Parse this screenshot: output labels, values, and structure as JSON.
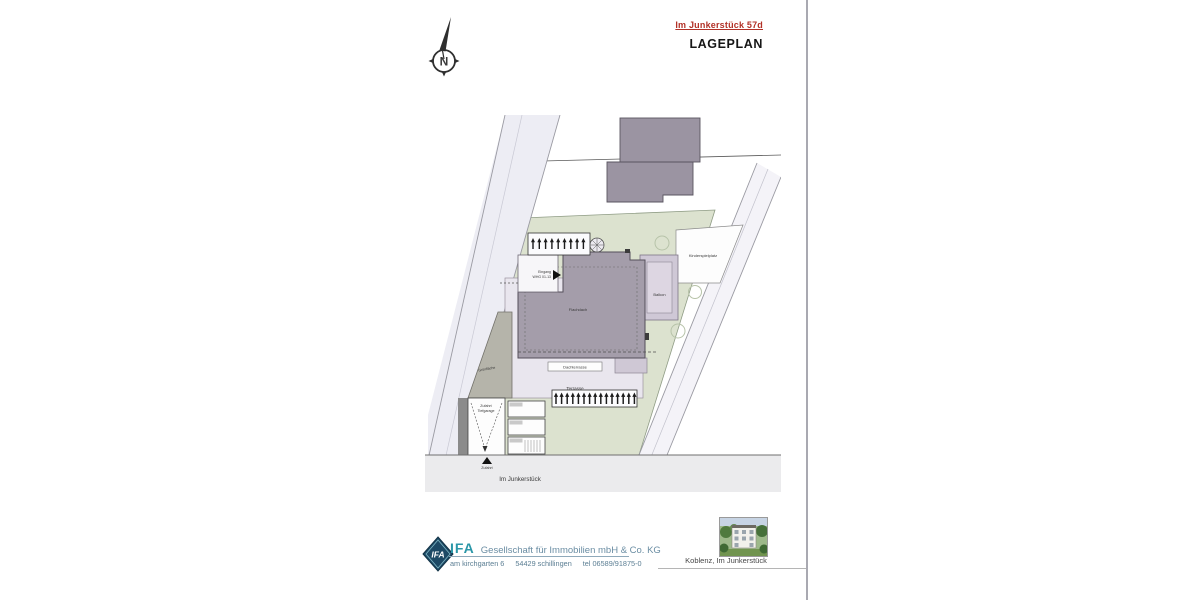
{
  "header": {
    "address": "Im Junkerstück 57d",
    "title": "LAGEPLAN"
  },
  "compass": {
    "letter": "N"
  },
  "plan": {
    "street_label": "Im Junkerstück",
    "areas": {
      "kinderspielplatz": "Kinderspielplatz",
      "balkon": "Balkon",
      "flachdach": "Flachdach",
      "dachterrasse": "Dachterrasse",
      "terrasse": "Terrasse",
      "gruenflaeche": "Grünfläche"
    },
    "entrance": {
      "line1": "Eingang",
      "line2": "WHG 01-13"
    },
    "ramp": {
      "line1": "Zufahrt",
      "line2": "Tiefgarage"
    },
    "driveway_label": "Zufahrt",
    "bike_racks_top_count": 9,
    "bike_racks_bottom_count": 15,
    "parking_stall_count": 3
  },
  "footer": {
    "logo": "IFA",
    "company_bold": "IFA",
    "company_rest": "Gesellschaft für Immobilien mbH & Co. KG",
    "address_parts": [
      "am kirchgarten 6",
      "54429 schillingen",
      "tel 06589/91875-0"
    ],
    "photo_caption": "Koblenz, Im Junkerstück"
  },
  "colors": {
    "accent_red": "#b23127",
    "logo_teal": "#2b97a8",
    "green_area": "#dce2cf",
    "building_gray": "#a49daa",
    "footprint_lavender": "#d3ccd9"
  }
}
